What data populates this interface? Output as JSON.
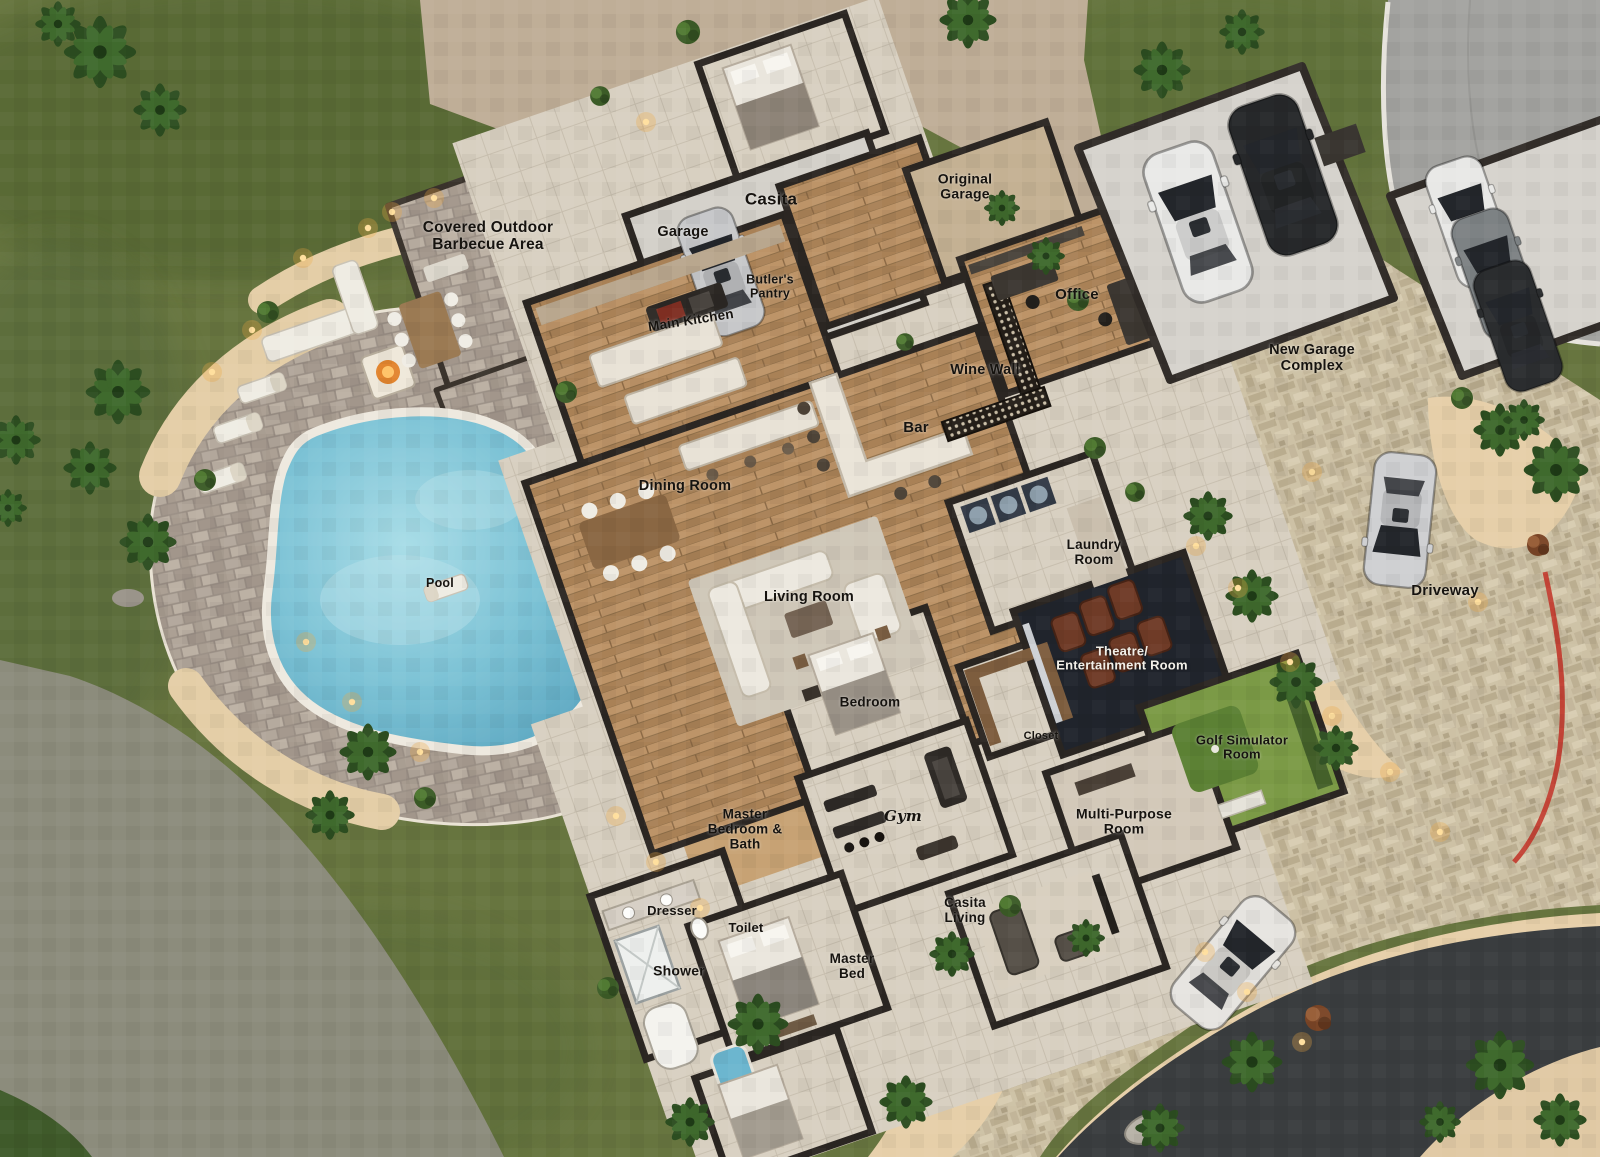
{
  "scene": {
    "type": "aerial-3d-floor-plan-rendering",
    "description": "Top-down dusk rendering of a luxury estate: main house with casita, pool with paver patio, covered outdoor barbecue area, original garage wing, new garage complex with paver driveway, golf simulator and theatre rooms, surrounded by lawn and palm landscaping"
  },
  "labels": {
    "covered_outdoor_barbecue_area": "Covered Outdoor Barbecue Area",
    "garage": "Garage",
    "casita": "Casita",
    "original_garage": "Original Garage",
    "butlers_pantry": "Butler's Pantry",
    "main_kitchen": "Main Kitchen",
    "office": "Office",
    "wine_wall": "Wine Wall",
    "bar": "Bar",
    "new_garage_complex": "New Garage Complex",
    "dining_room": "Dining Room",
    "pool": "Pool",
    "living_room": "Living Room",
    "laundry_room": "Laundry Room",
    "theatre_entertainment_room": "Theatre/ Entertainment Room",
    "driveway": "Driveway",
    "bedroom": "Bedroom",
    "closet": "Closet",
    "golf_simulator_room": "Golf Simulator Room",
    "multi_purpose_room": "Multi-Purpose Room",
    "master_bedroom_bath": "Master Bedroom & Bath",
    "gym": "Gym",
    "casita_living": "Casita Living",
    "dresser": "Dresser",
    "toilet": "Toilet",
    "shower": "Shower",
    "master_bed": "Master Bed"
  },
  "objects": {
    "pool": "free-form pool with white coping",
    "fire_pit": "fire pit with outdoor sectional",
    "loungers": 4,
    "vehicles": [
      "silver car in casita garage",
      "white car in new garage bay",
      "black car in new garage bay",
      "white car in side garage bay",
      "gray car in side garage bay",
      "black car in side garage bay",
      "silver car on driveway",
      "white car on lower driveway"
    ],
    "landscaping": "palm trees, desert bushes, warm path lights, red garden hose line"
  },
  "palette": {
    "grass": "#67753f",
    "grass_dark": "#4d5f30",
    "field_gray_green": "#8c8c7c",
    "dirt": "#bfae97",
    "sand": "#e6cfa9",
    "paver_beige": "#cdc1a5",
    "paver_gray": "#a89d92",
    "road_light": "#a3a3a0",
    "road_dark": "#3a3d3f",
    "wall": "#2b2622",
    "wood_floor": "#b28a5d",
    "tile_floor": "#d8d0c1",
    "water": "#7cc2d5",
    "theater_floor": "#20242c",
    "golf_green": "#7b9a46",
    "accent_red": "#c2372b",
    "label_text": "#16130f"
  }
}
